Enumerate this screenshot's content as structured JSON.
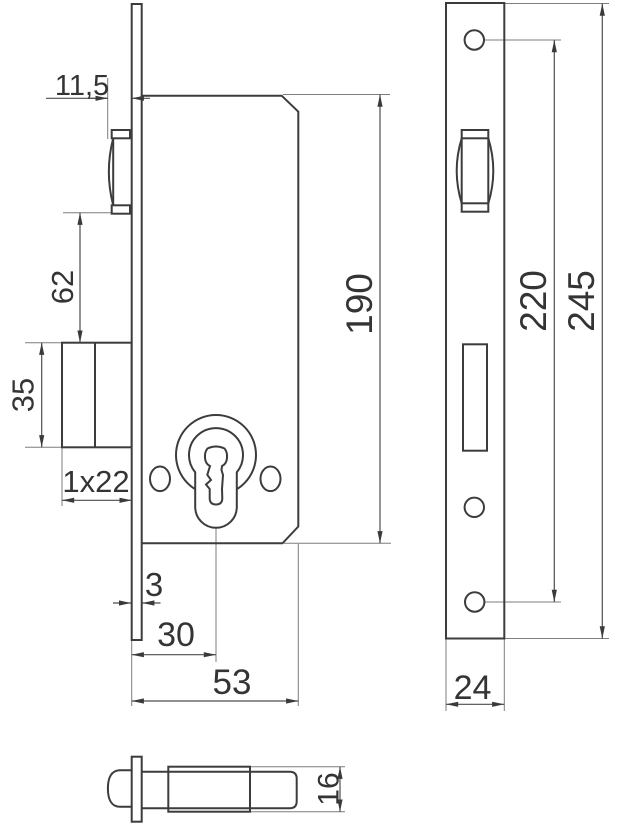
{
  "drawing": {
    "colors": {
      "outline": "#3c3c3c",
      "dimension_lines": "#4d4d4d",
      "extension_lines": "#7d7d7d",
      "text": "#343434",
      "background": "#ffffff"
    },
    "dimensions": {
      "side_view": {
        "latch_projection": "11,5",
        "latch_to_deadbolt": "62",
        "deadbolt_height": "35",
        "deadbolt_throw": "1x22",
        "faceplate_thickness": "3",
        "backset": "30",
        "case_depth": "53",
        "case_height": "190"
      },
      "front_view": {
        "screw_hole_spacing": "220",
        "faceplate_length": "245",
        "faceplate_width": "24"
      },
      "bottom_view": {
        "case_thickness": "16"
      }
    }
  }
}
